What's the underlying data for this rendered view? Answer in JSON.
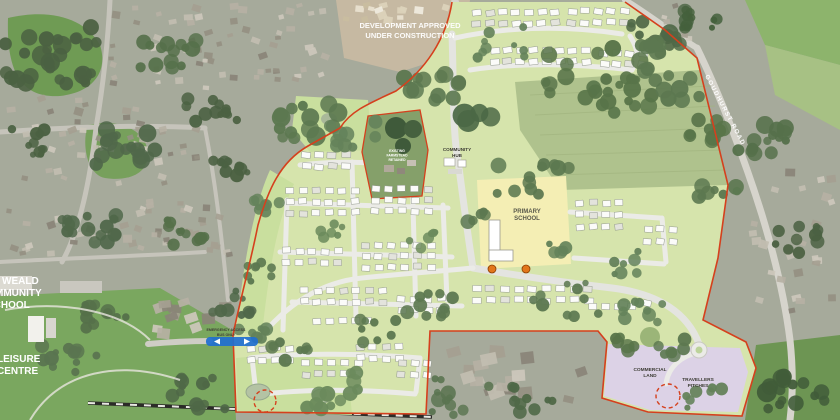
{
  "map": {
    "labels": {
      "construction": {
        "line1": "DEVELOPMENT APPROVED",
        "line2": "UNDER CONSTRUCTION"
      },
      "primary_school": {
        "line1": "PRIMARY",
        "line2": "SCHOOL"
      },
      "community_hub": {
        "line1": "COMMUNITY",
        "line2": "HUB"
      },
      "commercial_land": {
        "line1": "COMMERCIAL",
        "line2": "LAND"
      },
      "travellers_pitches": {
        "line1": "TRAVELLERS",
        "line2": "PITCHES"
      },
      "school_left": {
        "line1": "WEALD",
        "line2": "COMMUNITY",
        "line3": "SCHOOL"
      },
      "leisure_centre": {
        "line1": "LEISURE",
        "line2": "CENTRE"
      },
      "road_right": "GOUDHURST ROAD",
      "access_note": {
        "line1": "EMERGENCY ACCESS",
        "line2": "BUS ONLY"
      },
      "farm_note": {
        "line1": "EXISTING",
        "line2": "FARMSTEAD",
        "line3": "RETAINED"
      }
    },
    "colors": {
      "boundary": "#d5401d",
      "plan_green": "#d6e4ac",
      "open_green": "#c9df9e",
      "field_green": "#afc28d",
      "school_yellow": "#f4eeb4",
      "lavender": "#dcd2e6",
      "street": "#ebebe7",
      "aerial_base": "#a6aa9b",
      "aerial_green": "#719957",
      "leisure_green": "#7aa75f",
      "house_white": "#fbfbf9",
      "railway_dark": "#2b2b28",
      "bus_blue": "#1f6fd0",
      "marker_orange": "#e2761b",
      "pond": "#b4c3a4",
      "tree_dark": "#546f49"
    }
  }
}
